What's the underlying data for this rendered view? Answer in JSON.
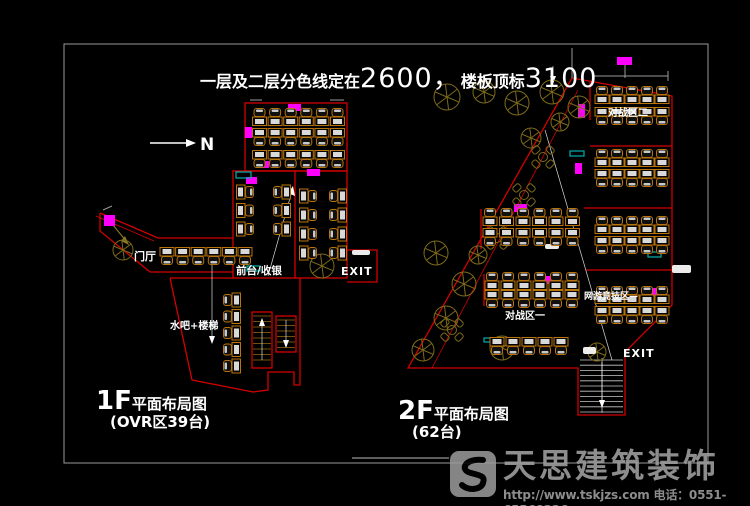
{
  "title": {
    "prefix": "一层及二层分色线定在",
    "value1": "2600，",
    "middle": "楼板顶标",
    "value2": "3100"
  },
  "north": {
    "label": "N"
  },
  "plan_1f": {
    "floor": "1F",
    "name": "平面布局图",
    "count": "(OVR区39台)",
    "labels": {
      "entrance": "门厅",
      "counter": "前台/收银",
      "water_bar": "水吧+楼梯",
      "exit": "EXIT"
    }
  },
  "plan_2f": {
    "floor": "2F",
    "name": "平面布局图",
    "count": "(62台)",
    "labels": {
      "zone2": "对战区二",
      "zone1": "对战区一",
      "net_zone": "网游竞技区—",
      "exit": "EXIT"
    }
  },
  "watermark": {
    "brand": "天思建筑装饰",
    "contact": "http://www.tskjzs.com 电话：0551-65568226"
  },
  "colors": {
    "wall": "#d40000",
    "desk": "#b97309",
    "marker": "#ff00ff",
    "counter": "#00b0b0",
    "tree": "#7d6b1a",
    "text": "#ffffff",
    "frame": "#9a9a9a",
    "watermark": "#9d9d9d",
    "monitor": "#d9d9d9"
  }
}
